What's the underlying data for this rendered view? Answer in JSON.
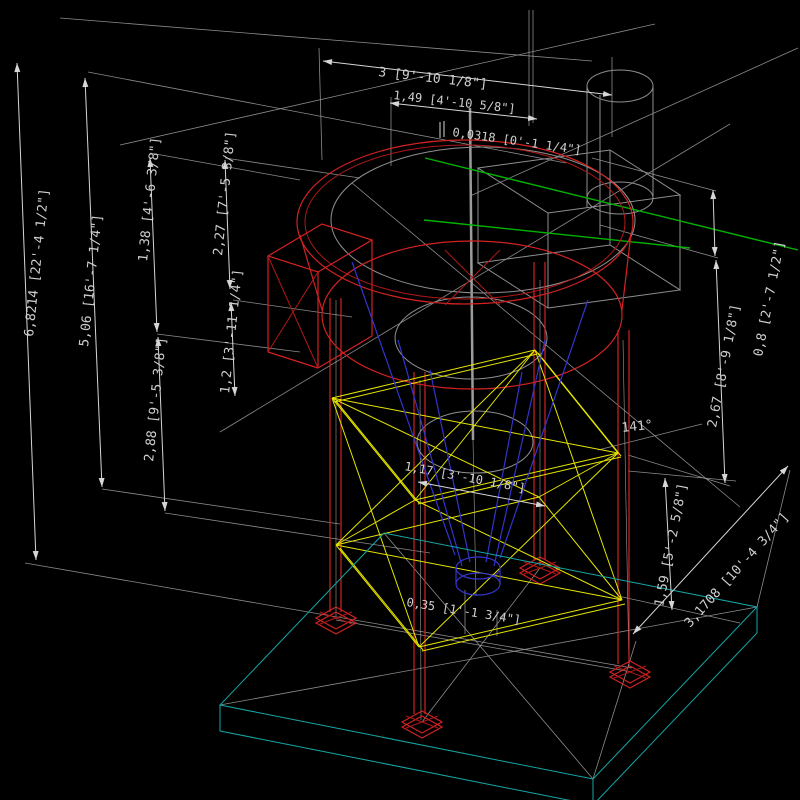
{
  "app": {
    "type": "cad-3d-viewport",
    "background": "#000000",
    "description": "Wireframe isometric view of elevated silo tank on braced steel support structure with concrete base pad and dimension annotations"
  },
  "colors": {
    "dimension_lines": "#d6d6d6",
    "construction_lines": "#9a9a9a",
    "structure_red": "#d42222",
    "bracing_yellow": "#e6e600",
    "base_cyan": "#14a8a8",
    "hopper_blue": "#3434cc",
    "accent_green": "#00b400",
    "wireframe_gray": "#8f8f8f",
    "text": "#cfcfcf"
  },
  "dims": {
    "top_main": "3 [9'-10 1/8\"]",
    "top_sub": "1,49 [4'-10 5/8\"]",
    "top_small": "0,0318 [0'-1 1/4\"]",
    "left_total": "6,8214 [22'-4 1/2\"]",
    "left_upper": "5,06 [16'-7 1/4\"]",
    "left_a": "1,38 [4'-6 3/8\"]",
    "left_b": "2,27 [7'-5 3/8\"]",
    "left_c": "2,88 [9'-5 3/8\"]",
    "left_d": "1,2 [3'-11 1/4\"]",
    "right_a": "0,8 [2'-7 1/2\"]",
    "right_b": "2,67 [8'-9 1/8\"]",
    "right_c": "1,59 [5'-2 5/8\"]",
    "right_d": "3,1708 [10'-4 3/4\"]",
    "mid_a": "1,17 [3'-10 1/8\"]",
    "mid_b": "0,35 [1'-1 3/4\"]",
    "angle": "141°"
  }
}
